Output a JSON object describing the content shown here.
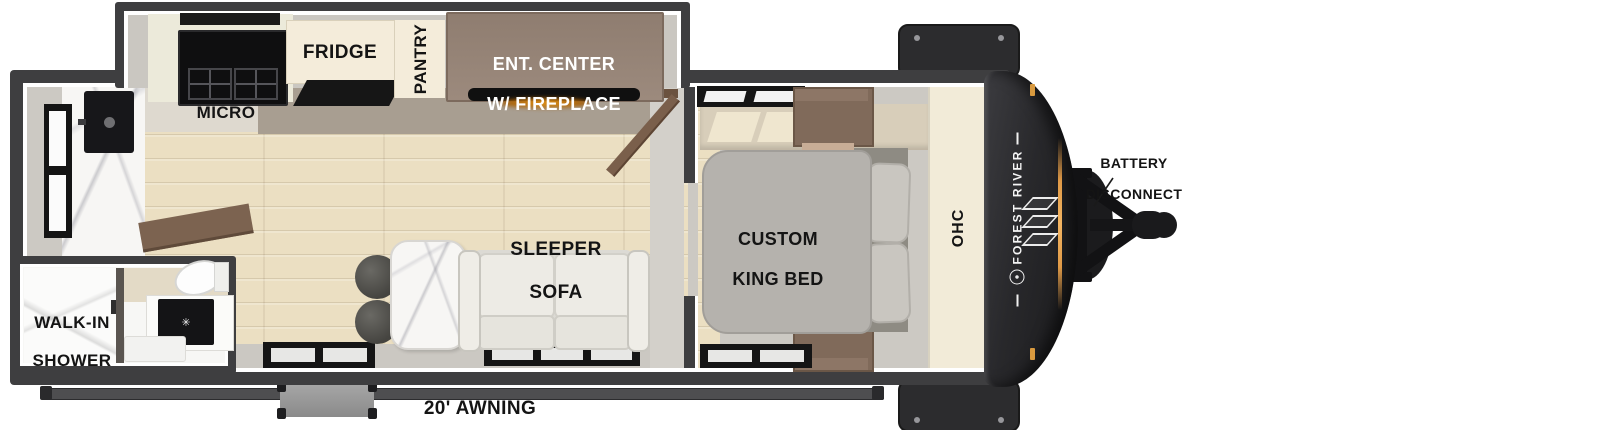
{
  "floorplan": {
    "brand": "FOREST RIVER",
    "labels": {
      "micro": "MICRO",
      "fridge": "FRIDGE",
      "pantry": "PANTRY",
      "ent_center_1": "ENT. CENTER",
      "ent_center_2": "W/ FIREPLACE",
      "sleeper_sofa_1": "SLEEPER",
      "sleeper_sofa_2": "SOFA",
      "king_bed_1": "CUSTOM",
      "king_bed_2": "KING BED",
      "ohc": "OHC",
      "walk_in_1": "WALK-IN",
      "walk_in_2": "SHOWER",
      "awning": "20' AWNING",
      "battery_1": "BATTERY",
      "battery_2": "DISCONNECT",
      "sink_drain": "✳"
    },
    "colors": {
      "outer_wall": "#3E3E40",
      "interior_gray": "#CCC9C3",
      "floor_wood": "#EBDFC2",
      "cream_cabinet": "#F4ECDA",
      "ent_center_tan": "#9B897C",
      "wardrobe_brown": "#806A5A",
      "front_cap_dark": "#232326",
      "amber_light": "#E8A24C",
      "label_dark": "#141414",
      "label_light": "#FFFFFF"
    }
  }
}
